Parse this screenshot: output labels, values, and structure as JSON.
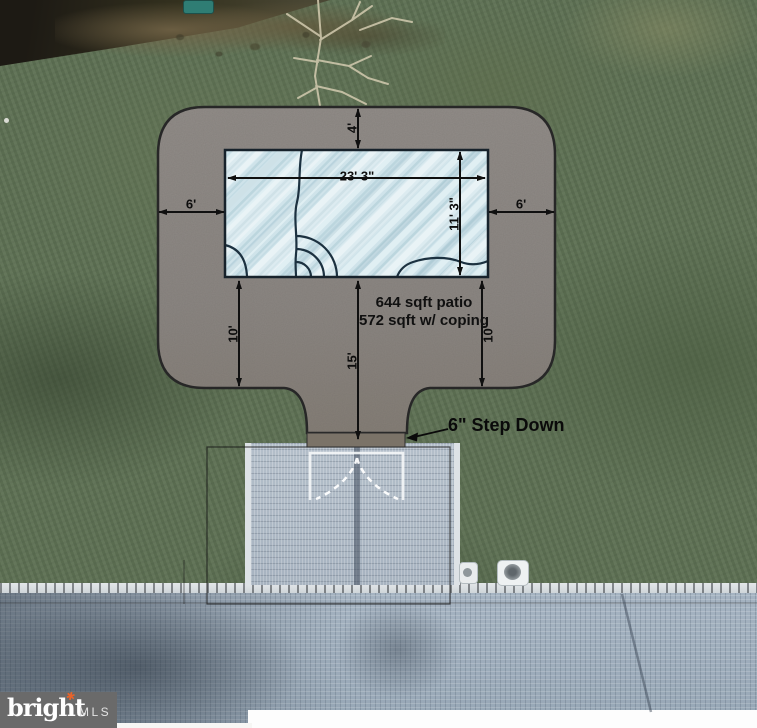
{
  "diagram": {
    "title_hint": "patio and pool plan overlaid on aerial photo",
    "dimensions": {
      "top_offset": "4'",
      "pool_width": "23' 3\"",
      "pool_depth": "11' 3\"",
      "left_margin": "6'",
      "right_margin": "6'",
      "lower_left": "10'",
      "lower_right": "10'",
      "center_run": "15'"
    },
    "notes": {
      "area_line1": "644 sqft patio",
      "area_line2": "572 sqft w/ coping",
      "step_down": "6\" Step Down"
    }
  },
  "watermark": {
    "brand": "bright",
    "suffix": "MLS",
    "accent_color": "#e8632a",
    "box_color": "#6a6a6a"
  },
  "colors": {
    "patio": "#8d8884",
    "pool": "#cfe3ea",
    "grass": "#5e7154",
    "roof": "#a2b1c0",
    "dimension_ink": "#101010"
  }
}
